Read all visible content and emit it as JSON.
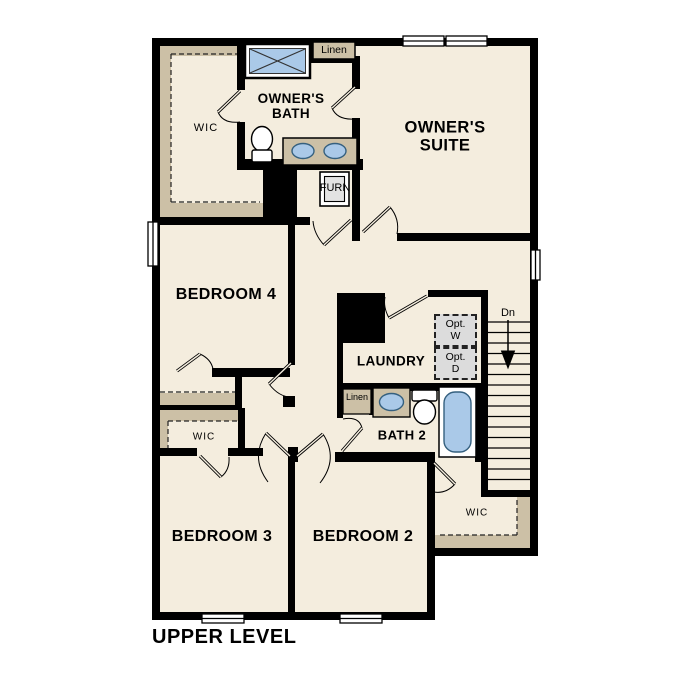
{
  "title": "UPPER LEVEL",
  "rooms": {
    "owners_suite": "OWNER'S\nSUITE",
    "owners_bath": "OWNER'S\nBATH",
    "bedroom4": "BEDROOM 4",
    "bedroom3": "BEDROOM 3",
    "bedroom2": "BEDROOM 2",
    "laundry": "LAUNDRY",
    "bath2": "BATH 2"
  },
  "closets": {
    "owners_wic": "WIC",
    "hall_wic": "WIC",
    "bedroom2_wic": "WIC",
    "linen_upper": "Linen",
    "linen_bath2": "Linen"
  },
  "fixtures": {
    "furnace": "FURN",
    "optional_washer": "Opt.\nW",
    "optional_dryer": "Opt.\nD"
  },
  "stairs": {
    "down_label": "Dn"
  },
  "colors": {
    "floor": "#f4edde",
    "casework_tan": "#ccc0a6",
    "fixture_blue": "#aac9e8",
    "wall_black": "#000000",
    "optional_gray": "#dcdcdc"
  }
}
